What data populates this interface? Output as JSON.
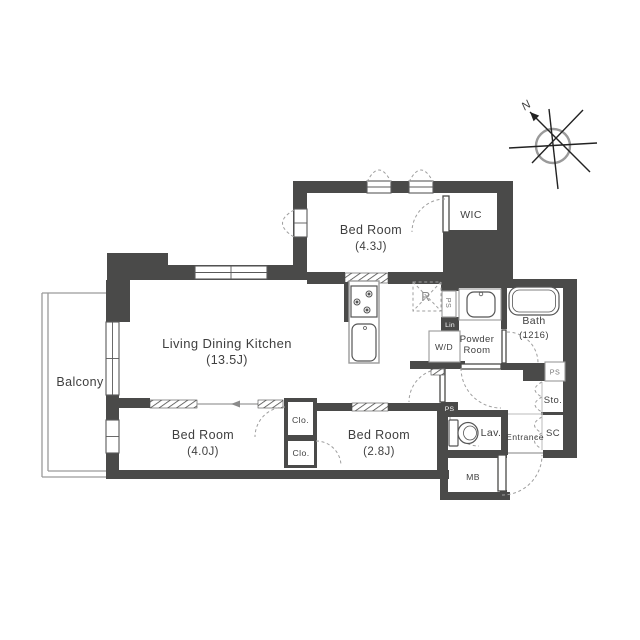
{
  "rooms": {
    "ldk": {
      "label": "Living Dining Kitchen",
      "size": "(13.5J)"
    },
    "bedroom_4_3": {
      "label": "Bed Room",
      "size": "(4.3J)"
    },
    "bedroom_4_0": {
      "label": "Bed Room",
      "size": "(4.0J)"
    },
    "bedroom_2_8": {
      "label": "Bed Room",
      "size": "(2.8J)"
    },
    "balcony": {
      "label": "Balcony"
    },
    "wic": {
      "label": "WIC"
    },
    "bath": {
      "label": "Bath",
      "size": "(1216)"
    },
    "powder_room": {
      "line1": "Powder",
      "line2": "Room"
    },
    "washer_dryer": {
      "label": "W/D"
    },
    "refrigerator": {
      "label": "R"
    },
    "pipe_space_kitchen": {
      "label": "PS"
    },
    "linen": {
      "label": "Lin"
    },
    "pipe_space_bath": {
      "label": "PS"
    },
    "pipe_space_hall": {
      "label": "PS"
    },
    "storage": {
      "label": "Sto."
    },
    "shoe_closet": {
      "label": "SC"
    },
    "entrance": {
      "label": "Entrance"
    },
    "lavatory": {
      "label": "Lav."
    },
    "meter_box": {
      "label": "MB"
    },
    "closet_upper": {
      "label": "Clo."
    },
    "closet_lower": {
      "label": "Clo."
    }
  },
  "compass": {
    "north": "N"
  },
  "colors": {
    "wall": "#4a4a49",
    "balcony_line": "#9a9a9a",
    "text": "#3f3f3f",
    "dashed": "#9f9f9f"
  }
}
